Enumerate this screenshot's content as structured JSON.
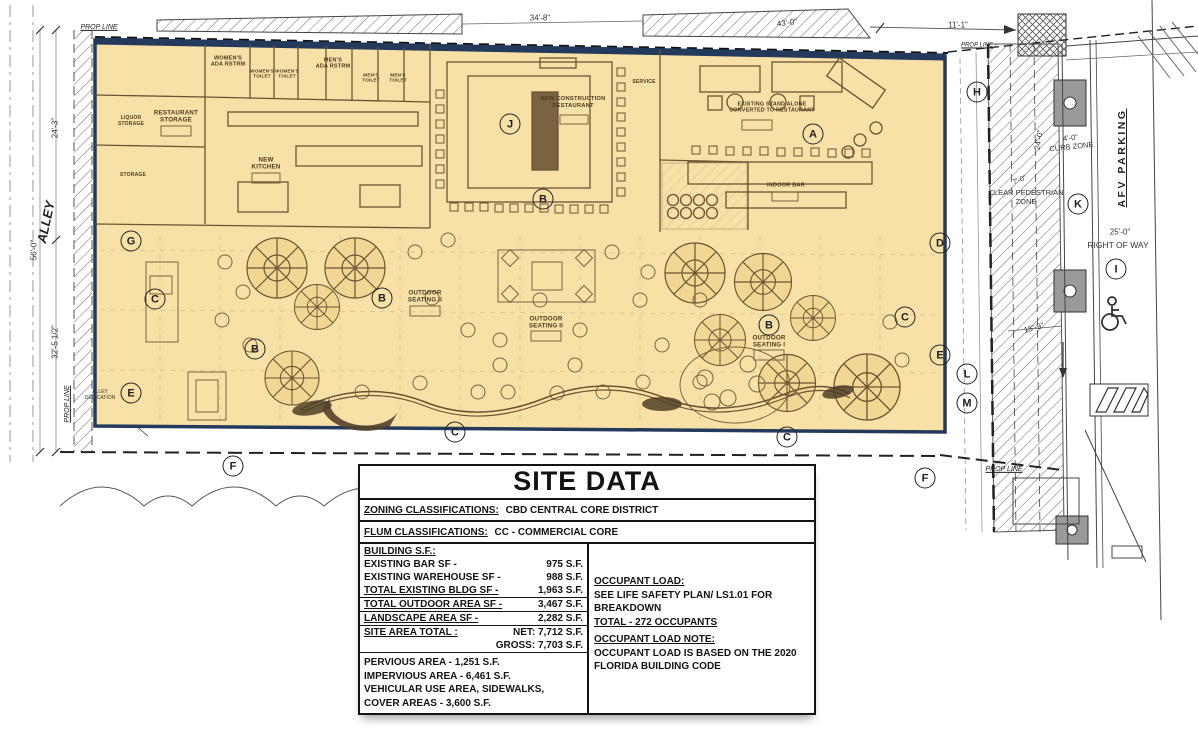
{
  "plan": {
    "street": {
      "afv_parking": "AFV PARKING"
    },
    "keynotes": [
      {
        "letter": "H",
        "x": 977,
        "y": 92
      },
      {
        "letter": "G",
        "x": 131,
        "y": 241
      },
      {
        "letter": "C",
        "x": 155,
        "y": 299
      },
      {
        "letter": "B",
        "x": 255,
        "y": 349
      },
      {
        "letter": "E",
        "x": 131,
        "y": 393
      },
      {
        "letter": "B",
        "x": 382,
        "y": 298
      },
      {
        "letter": "J",
        "x": 510,
        "y": 124
      },
      {
        "letter": "B",
        "x": 543,
        "y": 199
      },
      {
        "letter": "A",
        "x": 813,
        "y": 134
      },
      {
        "letter": "B",
        "x": 769,
        "y": 325
      },
      {
        "letter": "C",
        "x": 905,
        "y": 317
      },
      {
        "letter": "D",
        "x": 940,
        "y": 243
      },
      {
        "letter": "E",
        "x": 940,
        "y": 355
      },
      {
        "letter": "L",
        "x": 967,
        "y": 374
      },
      {
        "letter": "M",
        "x": 967,
        "y": 403
      },
      {
        "letter": "K",
        "x": 1078,
        "y": 204
      },
      {
        "letter": "I",
        "x": 1116,
        "y": 269
      },
      {
        "letter": "C",
        "x": 455,
        "y": 432
      },
      {
        "letter": "C",
        "x": 787,
        "y": 437
      },
      {
        "letter": "F",
        "x": 233,
        "y": 466
      },
      {
        "letter": "F",
        "x": 925,
        "y": 478
      }
    ],
    "room_labels": [
      {
        "t": "WOMEN'S\nADA RSTRM",
        "x": 228,
        "y": 62,
        "fs": 5.5
      },
      {
        "t": "WOMEN'S\nTOILET",
        "x": 262,
        "y": 74,
        "fs": 4.6
      },
      {
        "t": "WOMEN'S\nTOILET",
        "x": 287,
        "y": 74,
        "fs": 4.6
      },
      {
        "t": "MEN'S\nADA RSTRM",
        "x": 333,
        "y": 64,
        "fs": 5.5
      },
      {
        "t": "MEN'S\nTOILET",
        "x": 371,
        "y": 78,
        "fs": 4.6
      },
      {
        "t": "MEN'S\nTOILET",
        "x": 398,
        "y": 78,
        "fs": 4.6
      },
      {
        "t": "RESTAURANT\nSTORAGE",
        "x": 176,
        "y": 117,
        "fs": 6.2
      },
      {
        "t": "LIQUOR\nSTORAGE",
        "x": 131,
        "y": 122,
        "fs": 5
      },
      {
        "t": "STORAGE",
        "x": 133,
        "y": 176,
        "fs": 5
      },
      {
        "t": "NEW\nKITCHEN",
        "x": 266,
        "y": 164,
        "fs": 6.2
      },
      {
        "t": "NEW CONSTRUCTION\nRESTAURANT",
        "x": 573,
        "y": 103,
        "fs": 5.8
      },
      {
        "t": "SERVICE",
        "x": 644,
        "y": 83,
        "fs": 5
      },
      {
        "t": "EXISTING STAND ALONE\nCONVERTED TO RESTAURANT",
        "x": 772,
        "y": 108,
        "fs": 5.4
      },
      {
        "t": "INDOOR BAR",
        "x": 786,
        "y": 186,
        "fs": 5.6
      },
      {
        "t": "OUTDOOR\nSEATING II",
        "x": 425,
        "y": 297,
        "fs": 6.2
      },
      {
        "t": "OUTDOOR\nSEATING II",
        "x": 546,
        "y": 323,
        "fs": 6.2
      },
      {
        "t": "OUTDOOR\nSEATING I",
        "x": 769,
        "y": 342,
        "fs": 6.2
      }
    ],
    "dim_labels": [
      {
        "t": "PROP LINE",
        "x": 99,
        "y": 28,
        "fs": 7,
        "cls": "prop"
      },
      {
        "t": "PROP LINE",
        "x": 977,
        "y": 46,
        "fs": 6,
        "cls": "prop"
      },
      {
        "t": "34'-8\"",
        "x": 540,
        "y": 18,
        "fs": 8
      },
      {
        "t": "43'-0\"",
        "x": 787,
        "y": 23,
        "fs": 8,
        "r": -7
      },
      {
        "t": "11'-1\"",
        "x": 958,
        "y": 25,
        "fs": 8
      },
      {
        "t": "24'-3\"",
        "x": 55,
        "y": 128,
        "fs": 8,
        "r": -90
      },
      {
        "t": "ALLEY",
        "x": 46,
        "y": 222,
        "fs": 13,
        "r": -78,
        "cls": "ital"
      },
      {
        "t": "56'-0\"",
        "x": 34,
        "y": 250,
        "fs": 8,
        "r": -90
      },
      {
        "t": "32'-5 1/2\"",
        "x": 55,
        "y": 342,
        "fs": 8,
        "r": -90
      },
      {
        "t": "PROP LINE",
        "x": 68,
        "y": 404,
        "fs": 7,
        "r": -90,
        "cls": "prop"
      },
      {
        "t": "ALLEY\nDEDICATION",
        "x": 100,
        "y": 396,
        "fs": 5
      },
      {
        "t": "24'-0\"",
        "x": 1039,
        "y": 140,
        "fs": 8,
        "r": -80
      },
      {
        "t": "4'-0\"\nCURB ZONE",
        "x": 1071,
        "y": 143,
        "fs": 7.5,
        "r": -6
      },
      {
        "t": "7'-0\"",
        "x": 1020,
        "y": 181,
        "fs": 7,
        "r": -20
      },
      {
        "t": "CLEAR PEDESTRIAN\nZONE",
        "x": 1026,
        "y": 198,
        "fs": 7.5
      },
      {
        "t": "25'-0\"",
        "x": 1120,
        "y": 232,
        "fs": 8
      },
      {
        "t": "RIGHT  OF  WAY",
        "x": 1118,
        "y": 245,
        "fs": 8.5
      },
      {
        "t": "15'-9\"",
        "x": 1034,
        "y": 328,
        "fs": 8,
        "r": -15
      },
      {
        "t": "PROP LINE",
        "x": 1004,
        "y": 470,
        "fs": 7,
        "cls": "prop"
      }
    ]
  },
  "site_data": {
    "title": "SITE DATA",
    "zoning": {
      "label": "ZONING CLASSIFICATIONS:",
      "value": "CBD CENTRAL CORE DISTRICT"
    },
    "flum": {
      "label": "FLUM CLASSIFICATIONS:",
      "value": "CC - COMMERCIAL CORE"
    },
    "building_rows": [
      {
        "label": "BUILDING S.F.:",
        "value": "",
        "cls": "hd"
      },
      {
        "label": "EXISTING BAR SF -",
        "value": "975 S.F."
      },
      {
        "label": "EXISTING WAREHOUSE SF -",
        "value": "988 S.F."
      },
      {
        "label": "TOTAL EXISTING BLDG SF -",
        "value": "1,963 S.F.",
        "cls": "hd bb"
      },
      {
        "label": "TOTAL OUTDOOR AREA SF -",
        "value": "3,467 S.F.",
        "cls": "hd bb"
      },
      {
        "label": "LANDSCAPE AREA SF -",
        "value": "2,282 S.F.",
        "cls": "hd bb"
      }
    ],
    "site_area": {
      "label": "SITE AREA TOTAL :",
      "net": "NET: 7,712 S.F.",
      "gross": "GROSS: 7,703 S.F."
    },
    "areas": [
      {
        "t": "PERVIOUS AREA - 1,251 S.F."
      },
      {
        "t": "IMPERVIOUS AREA - 6,461 S.F."
      },
      {
        "t": "VEHICULAR USE AREA, SIDEWALKS,"
      },
      {
        "t": "COVER AREAS - 3,600 S.F."
      }
    ],
    "occupant": {
      "heading": "OCCUPANT LOAD:",
      "lines": [
        {
          "t": "SEE LIFE SAFETY PLAN/ LS1.01 FOR"
        },
        {
          "t": "BREAKDOWN"
        }
      ],
      "total": "TOTAL - 272 OCCUPANTS",
      "note_heading": "OCCUPANT LOAD NOTE:",
      "note_lines": [
        {
          "t": "OCCUPANT LOAD IS BASED ON THE 2020"
        },
        {
          "t": "FLORIDA BUILDING CODE"
        }
      ]
    }
  }
}
